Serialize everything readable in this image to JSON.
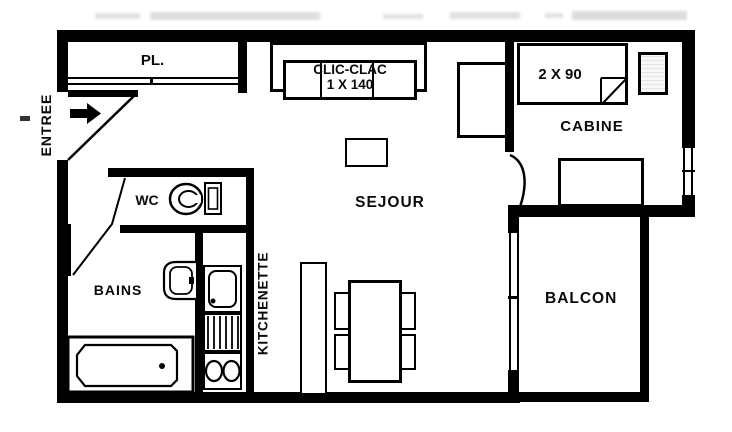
{
  "title": "Studio apartment floor plan",
  "labels": {
    "entree": "ENTREE",
    "pl": "PL.",
    "wc": "WC",
    "bains": "BAINS",
    "kitchenette": "KITCHENETTE",
    "sejour": "SEJOUR",
    "cabine": "CABINE",
    "balcon": "BALCON"
  },
  "furniture": {
    "clic_clac_name": "CLIC-CLAC",
    "clic_clac_size": "1 X 140",
    "cabine_beds_size": "2 X 90"
  },
  "icons": {
    "entry_arrow": "right-arrow",
    "fixtures": [
      "toilet",
      "washbasin",
      "bathtub",
      "kitchen-sink",
      "drainboard",
      "two-burner-stove"
    ]
  },
  "colors": {
    "wall": "#000000",
    "background": "#ffffff",
    "text": "#0a0a0a"
  }
}
